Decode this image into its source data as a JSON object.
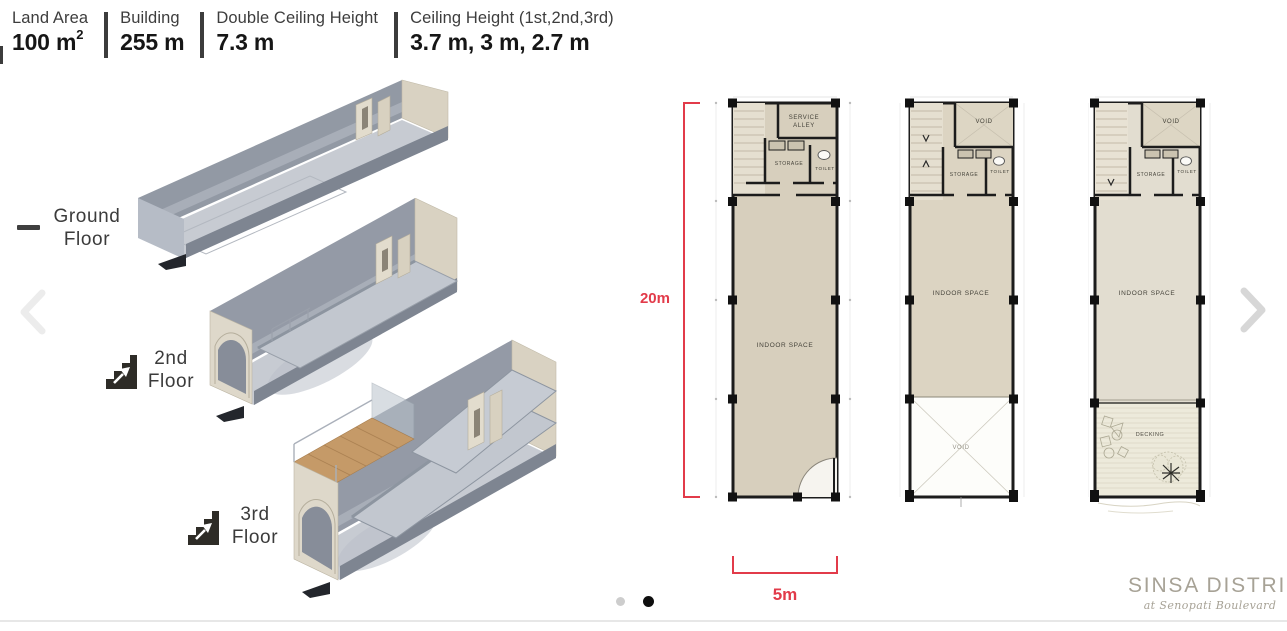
{
  "specs": [
    {
      "label": "Land Area",
      "value": "100 m",
      "sup": "2"
    },
    {
      "label": "Building",
      "value": "255 m",
      "sup": ""
    },
    {
      "label": "Double Ceiling Height",
      "value": "7.3 m",
      "sup": ""
    },
    {
      "label": "Ceiling Height (1st,2nd,3rd)",
      "value": "3.7 m, 3 m, 2.7 m",
      "sup": ""
    }
  ],
  "floor_labels": [
    {
      "line1": "Ground",
      "line2": "Floor"
    },
    {
      "line1": "2nd",
      "line2": "Floor"
    },
    {
      "line1": "3rd",
      "line2": "Floor"
    }
  ],
  "nav": {
    "prev": "‹",
    "next": "›"
  },
  "dimensions": {
    "height_label": "20m",
    "width_label": "5m"
  },
  "plan1": {
    "service_line1": "SERVICE",
    "service_line2": "ALLEY",
    "storage": "STORAGE",
    "toilet": "TOILET",
    "indoor": "INDOOR SPACE"
  },
  "plan2": {
    "void_top": "VOID",
    "storage": "STORAGE",
    "toilet": "TOILET",
    "indoor": "INDOOR SPACE",
    "void_bottom": "VOID"
  },
  "plan3": {
    "void_top": "VOID",
    "storage": "STORAGE",
    "toilet": "TOILET",
    "indoor": "INDOOR SPACE",
    "decking": "DECKING"
  },
  "branding": {
    "name": "SINSA DISTRICT",
    "tagline": "at Senopati Boulevard"
  },
  "colors": {
    "accent_red": "#e23b4a",
    "plan_fill": "#d7cfbd",
    "brand": "#a7a296"
  }
}
